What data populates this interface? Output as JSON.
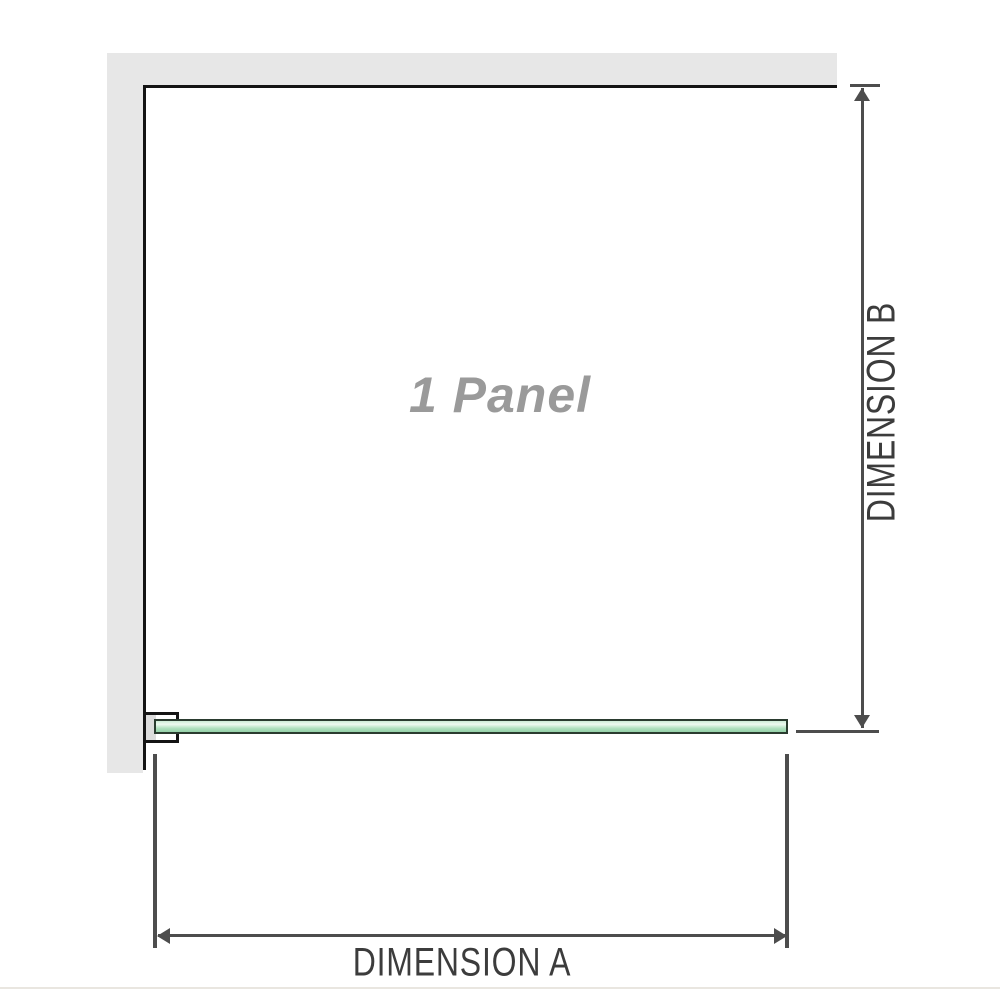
{
  "labels": {
    "panel": "1 Panel",
    "dimension_a": "DIMENSION A",
    "dimension_b": "DIMENSION B"
  },
  "colors": {
    "wall": "#e7e7e7",
    "outline": "#141414",
    "dimension_line": "#4d4d4d",
    "dimension_text": "#3c3c3c",
    "panel_text": "#9a9a9a",
    "bracket_pad": "#dcdcdc",
    "glass_border": "#2a3b2f",
    "glass_fill_light": "#cdebd6",
    "glass_highlight": "#eef9f0",
    "glass_fill": "#aedfbd",
    "glass_fill_dark": "#94d1a8",
    "footer_line": "#e9e6e0"
  }
}
